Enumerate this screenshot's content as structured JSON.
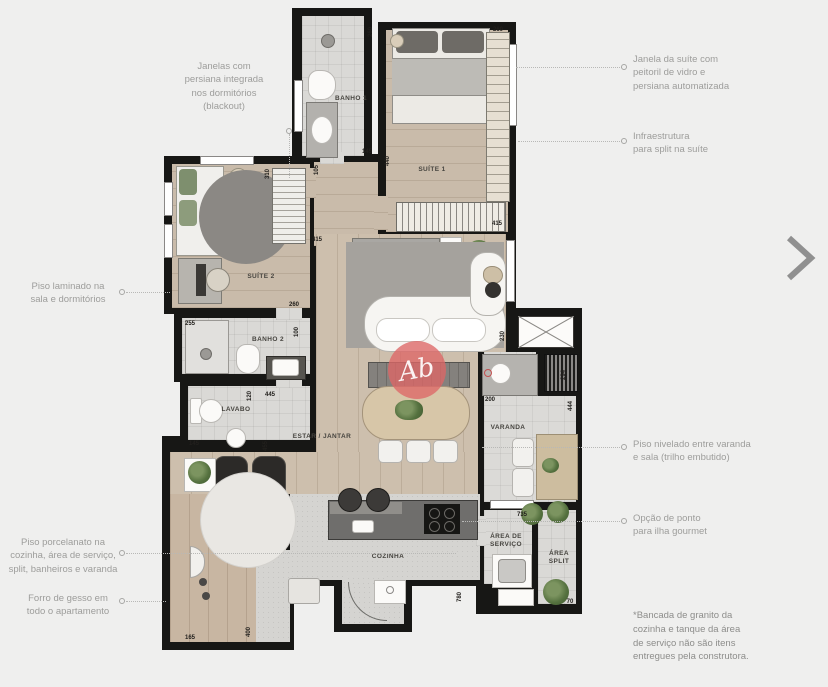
{
  "ui": {
    "next_arrow": "chevron-right"
  },
  "watermark": {
    "monogram": "Ab"
  },
  "colors": {
    "background": "#efefee",
    "wall": "#171715",
    "watermark_red": "#de6767",
    "annotation_gray": "#9d9d9b"
  },
  "annotations": {
    "janelas_blackout": "Janelas com\npersiana integrada\nnos dormitórios\n(blackout)",
    "piso_laminado": "Piso laminado na\nsala e dormitórios",
    "piso_porcelanato": "Piso porcelanato na\ncozinha, área de serviço,\nsplit, banheiros e varanda",
    "forro_gesso": "Forro de gesso em\ntodo o apartamento",
    "janela_suite": "Janela da suíte com\npeitoril de vidro e\npersiana automatizada",
    "infra_split": "Infraestrutura\npara split na suíte",
    "piso_nivelado": "Piso nivelado entre varanda\ne sala (trilho embutido)",
    "opcao_ponto": "Opção de ponto\npara ilha gourmet",
    "footnote": "*Bancada de granito da\ncozinha e tanque da área\nde serviço não são itens\nentregues pela construtora."
  },
  "rooms": {
    "banho1": "BANHO 1",
    "suite1": "SUÍTE 1",
    "suite2": "SUÍTE 2",
    "banho2": "BANHO 2",
    "lavabo": "LAVABO",
    "estar_jantar": "ESTAR / JANTAR",
    "varanda": "VARANDA",
    "cozinha": "COZINHA",
    "area_servico": "ÁREA DE\nSERVIÇO",
    "area_split": "ÁREA\nSPLIT"
  },
  "dimensions": [
    {
      "v": "260",
      "x": 371,
      "y": 32,
      "vert": true
    },
    {
      "v": "145",
      "x": 367,
      "y": 152,
      "vert": false
    },
    {
      "v": "440",
      "x": 388,
      "y": 161,
      "vert": true
    },
    {
      "v": "105",
      "x": 317,
      "y": 170,
      "vert": true
    },
    {
      "v": "415",
      "x": 317,
      "y": 240,
      "vert": false
    },
    {
      "v": "260",
      "x": 498,
      "y": 30,
      "vert": false
    },
    {
      "v": "415",
      "x": 497,
      "y": 224,
      "vert": false
    },
    {
      "v": "310",
      "x": 268,
      "y": 174,
      "vert": true
    },
    {
      "v": "260",
      "x": 294,
      "y": 305,
      "vert": false
    },
    {
      "v": "255",
      "x": 190,
      "y": 324,
      "vert": false
    },
    {
      "v": "100",
      "x": 297,
      "y": 332,
      "vert": true
    },
    {
      "v": "445",
      "x": 270,
      "y": 395,
      "vert": false
    },
    {
      "v": "120",
      "x": 250,
      "y": 396,
      "vert": true
    },
    {
      "v": "145",
      "x": 194,
      "y": 444,
      "vert": false
    },
    {
      "v": "455",
      "x": 266,
      "y": 446,
      "vert": true
    },
    {
      "v": "230",
      "x": 503,
      "y": 336,
      "vert": true
    },
    {
      "v": "294",
      "x": 564,
      "y": 375,
      "vert": true
    },
    {
      "v": "200",
      "x": 490,
      "y": 400,
      "vert": false
    },
    {
      "v": "444",
      "x": 571,
      "y": 406,
      "vert": true
    },
    {
      "v": "735",
      "x": 522,
      "y": 515,
      "vert": false
    },
    {
      "v": "70",
      "x": 570,
      "y": 602,
      "vert": false
    },
    {
      "v": "780",
      "x": 460,
      "y": 597,
      "vert": true
    },
    {
      "v": "165",
      "x": 190,
      "y": 638,
      "vert": false
    },
    {
      "v": "400",
      "x": 249,
      "y": 632,
      "vert": true
    }
  ]
}
